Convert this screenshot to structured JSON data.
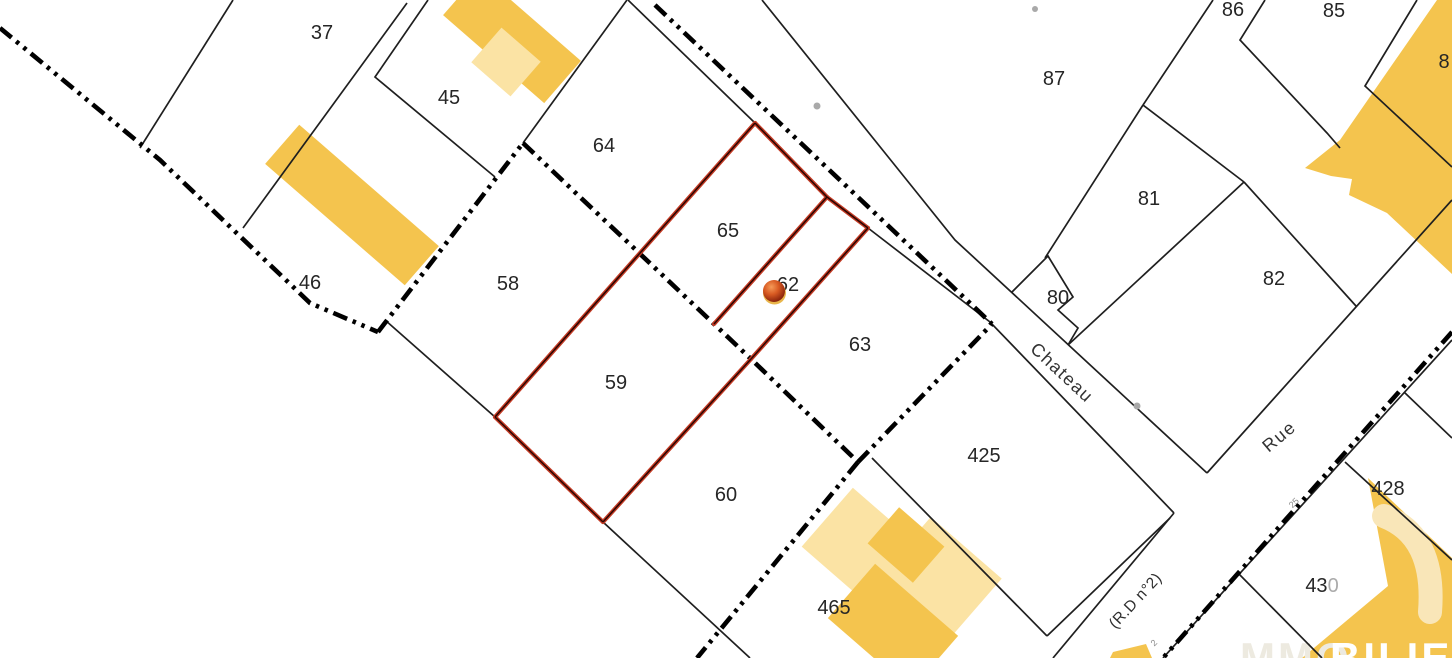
{
  "app": {
    "type": "cadastral-map-viewer"
  },
  "map": {
    "colors": {
      "background": "#FFFFFF",
      "parcel_line": "#1F1F1F",
      "boundary_dash": "#000000",
      "highlight_red": "#C33A24",
      "highlight_core": "#2A0602",
      "building_dark": "#F4C44E",
      "building_light": "#FBE3A4",
      "label": "#262626",
      "faded_label": "#ABABAB",
      "street_label": "#333333",
      "road_dot": "#A9A9A9",
      "watermark_yellow": "#F4C44E",
      "watermark_pale": "#F9E6B8",
      "watermark_faint_text": "#EDEAE0",
      "watermark_text": "#FFFFFF",
      "marker_orange": "#D85A22"
    },
    "parcels": [
      {
        "label": "37",
        "x": 322,
        "y": 39
      },
      {
        "label": "45",
        "x": 449,
        "y": 104
      },
      {
        "label": "46",
        "x": 310,
        "y": 289
      },
      {
        "label": "64",
        "x": 604,
        "y": 152
      },
      {
        "label": "58",
        "x": 508,
        "y": 290
      },
      {
        "label": "65",
        "x": 728,
        "y": 237
      },
      {
        "label": "62",
        "x": 788,
        "y": 291
      },
      {
        "label": "59",
        "x": 616,
        "y": 389
      },
      {
        "label": "63",
        "x": 860,
        "y": 351
      },
      {
        "label": "60",
        "x": 726,
        "y": 501
      },
      {
        "label": "465",
        "x": 834,
        "y": 614
      },
      {
        "label": "425",
        "x": 984,
        "y": 462
      },
      {
        "label": "80",
        "x": 1058,
        "y": 304
      },
      {
        "label": "81",
        "x": 1149,
        "y": 205
      },
      {
        "label": "87",
        "x": 1054,
        "y": 85
      },
      {
        "label": "86",
        "x": 1233,
        "y": 16
      },
      {
        "label": "85",
        "x": 1334,
        "y": 17
      },
      {
        "label": "82",
        "x": 1274,
        "y": 285
      },
      {
        "label": "8",
        "x": 1444,
        "y": 68
      },
      {
        "label": "428",
        "x": 1388,
        "y": 495
      },
      {
        "label": "43",
        "faded": "0",
        "x": 1322,
        "y": 592
      }
    ],
    "streets": [
      {
        "name": "Chateau",
        "x": 1058,
        "y": 377,
        "angle": 43,
        "kind": "street"
      },
      {
        "name": "Rue",
        "x": 1283,
        "y": 441,
        "angle": -40,
        "kind": "street"
      },
      {
        "name": "(R.D n°2)",
        "x": 1139,
        "y": 604,
        "angle": -47,
        "kind": "road_ref"
      }
    ],
    "road_markers": [
      {
        "text": "25",
        "x": 1296,
        "y": 505,
        "angle": -45
      },
      {
        "text": "2",
        "x": 1156,
        "y": 645,
        "angle": -45
      }
    ],
    "marker": {
      "x": 774,
      "y": 291
    },
    "watermark": {
      "text_main": "BILIER",
      "text_faint": "MMO"
    }
  }
}
